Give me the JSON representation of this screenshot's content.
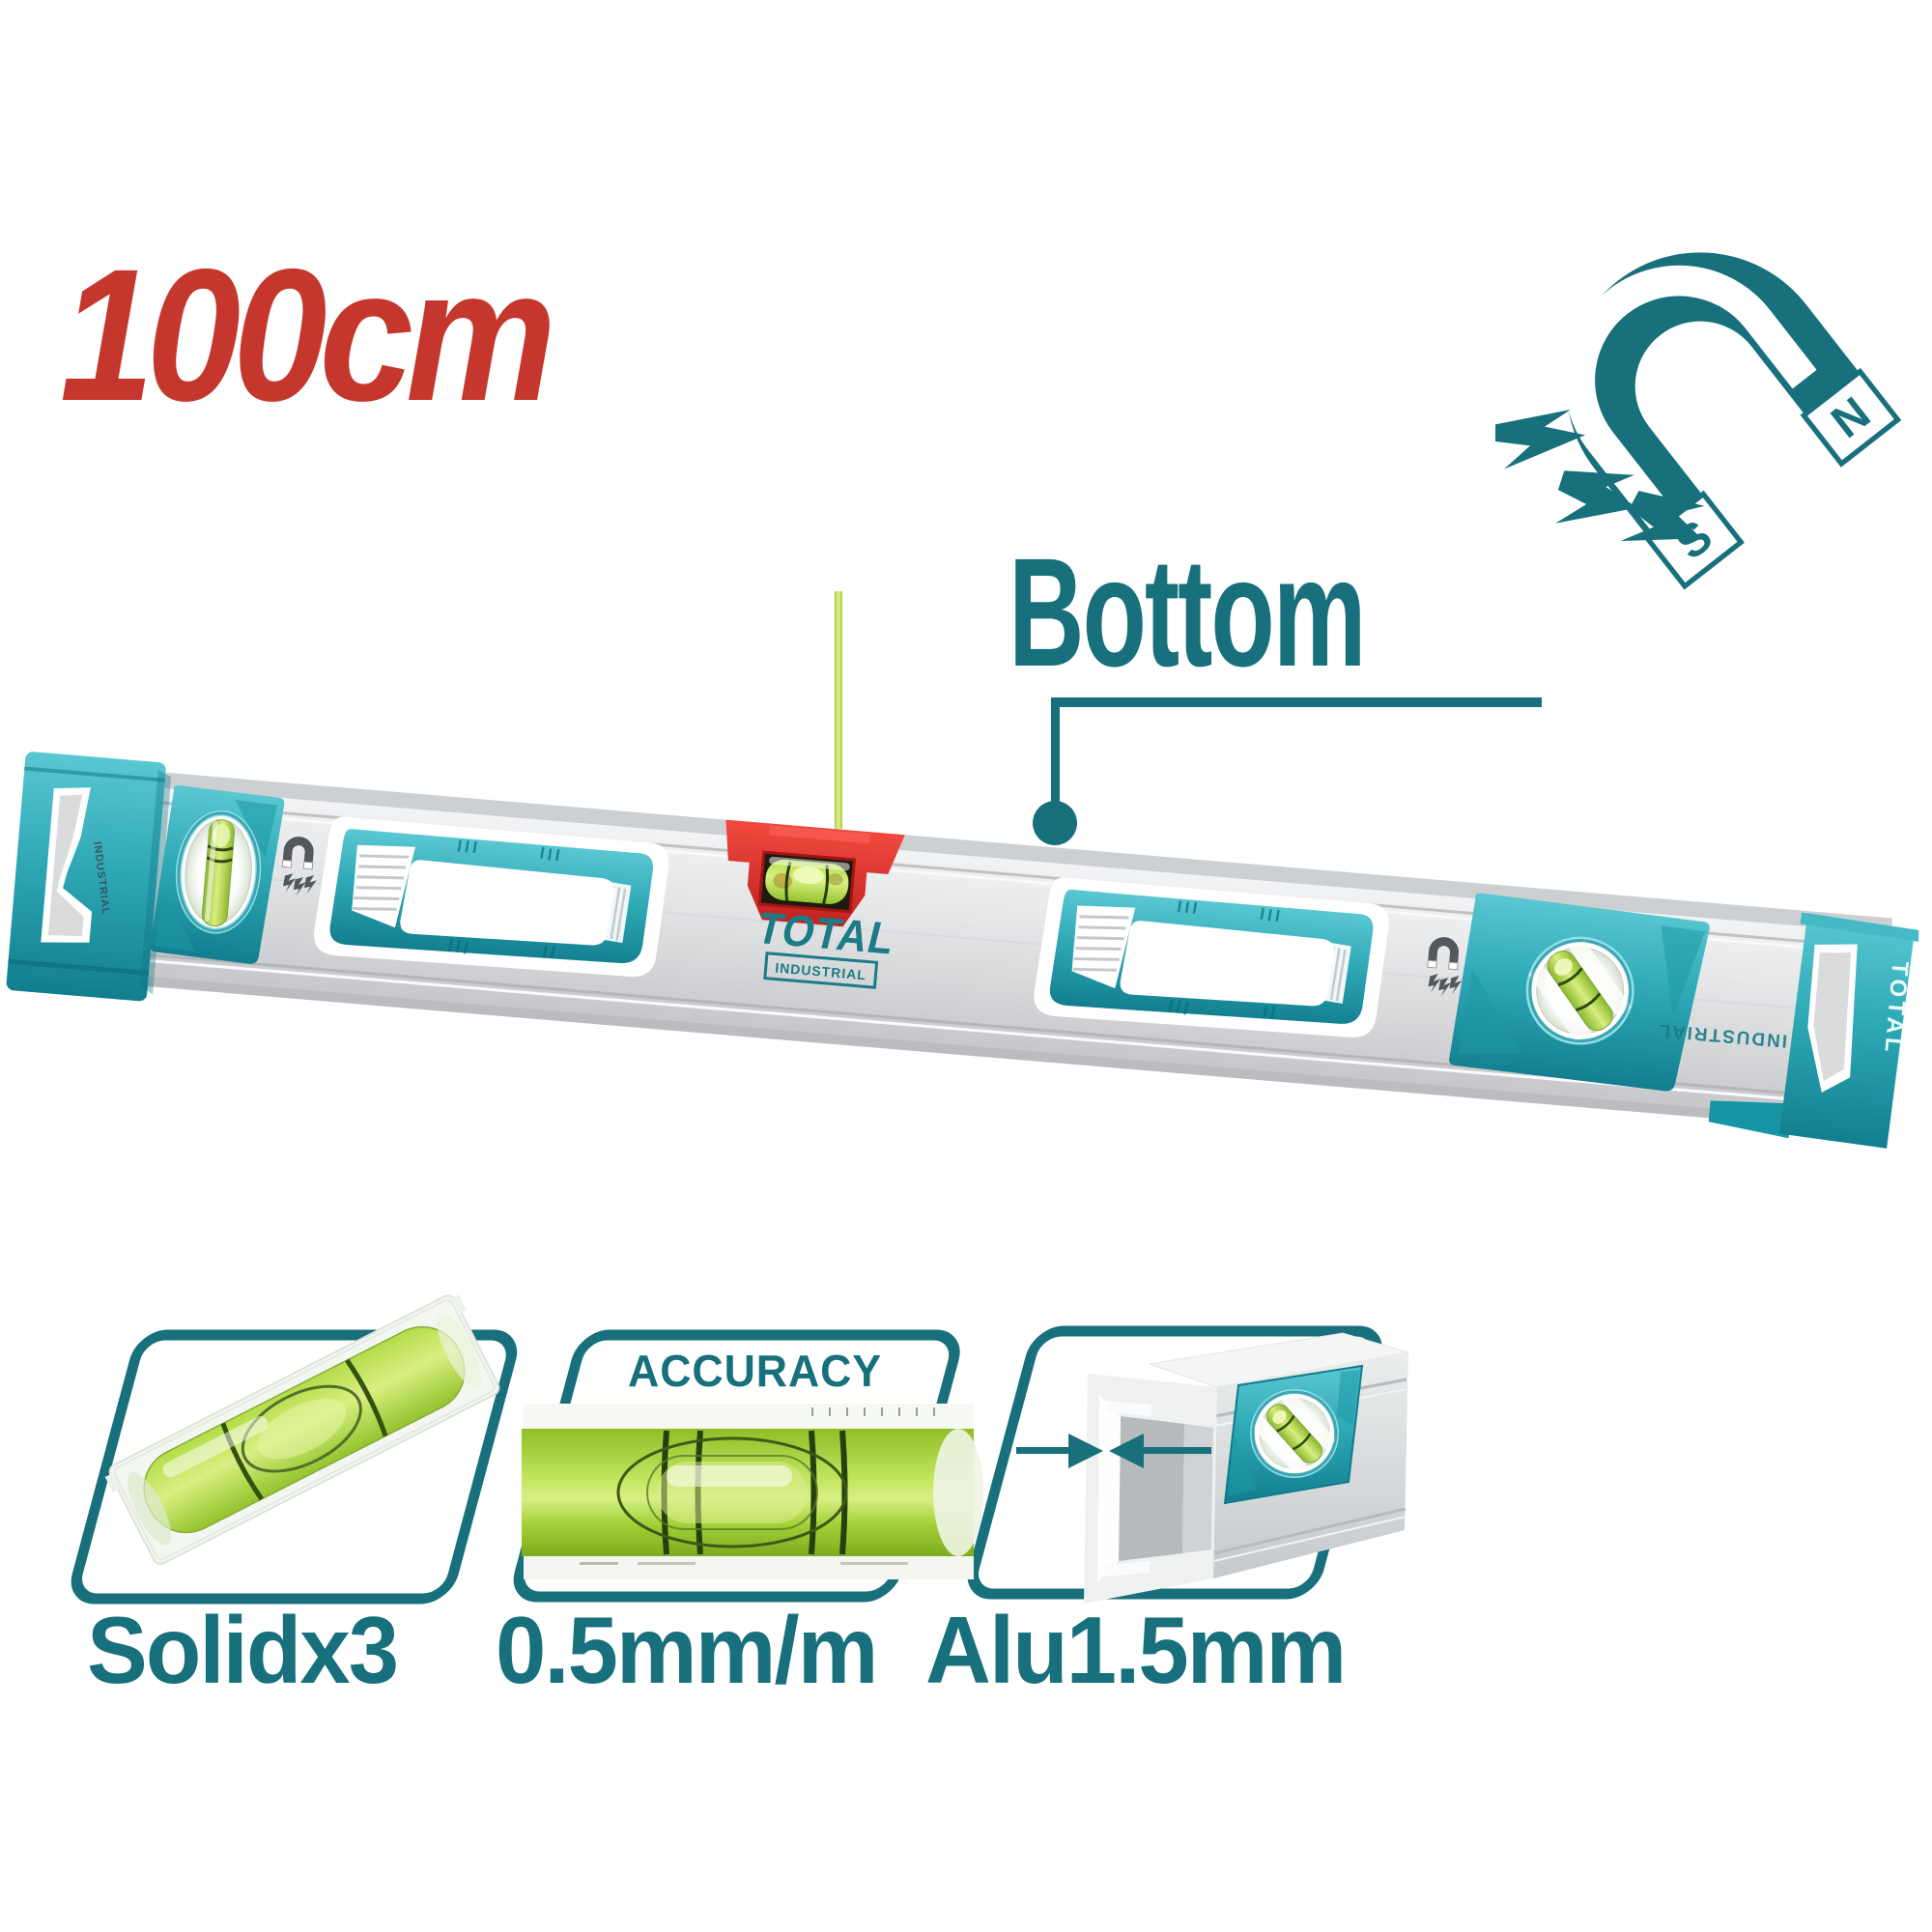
{
  "size_callout": {
    "text": "100cm",
    "color": "#C5372D"
  },
  "magnet_icon": {
    "south_pole": "S",
    "north_pole": "N",
    "color": "#17707C"
  },
  "callout": {
    "label": "Bottom"
  },
  "product": {
    "brand": "TOTAL",
    "line": "INDUSTRIAL",
    "cap_brand_vertical": "TOTAL",
    "flipped_body_print": "INDUSTRIAL",
    "end_cap_small_print": "INDUSTRIAL"
  },
  "features": [
    {
      "name": "solid-vials",
      "label": "Solidx3"
    },
    {
      "name": "accuracy",
      "heading": "ACCURACY",
      "label": "0.5mm/m"
    },
    {
      "name": "aluminum-thickness",
      "label": "Alu1.5mm"
    }
  ],
  "colors": {
    "brand_teal": "#17707C",
    "plastic_teal": "#2FA9B6",
    "accent_red": "#C5372D",
    "vial_green": "#BBDF4A",
    "aluminum": "#DFE1E3"
  }
}
